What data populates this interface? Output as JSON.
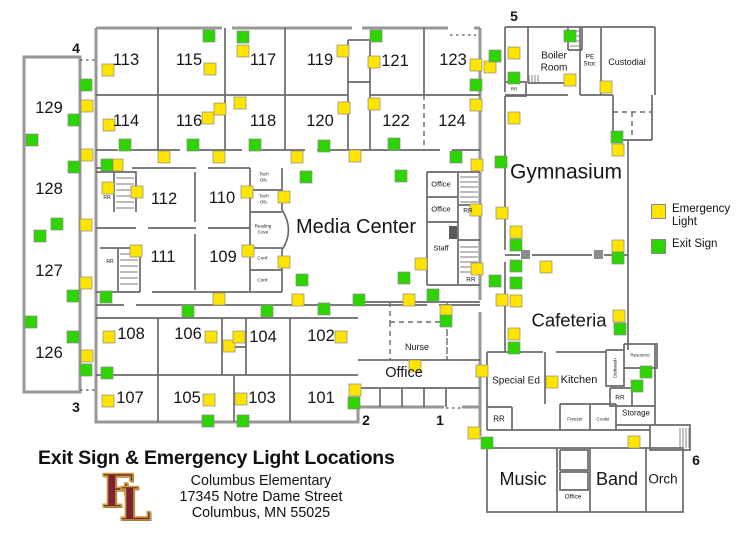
{
  "colors": {
    "emergency": "#ffe400",
    "exit": "#2ed400",
    "square_border": "#8a8a8a",
    "marker": "#d22b2b",
    "wall": "#6a6a6a",
    "outer_wall": "#979797"
  },
  "legend": {
    "emergency_label": "Emergency Light",
    "exit_label": "Exit Sign"
  },
  "title_block": {
    "title": "Exit Sign & Emergency Light Locations",
    "org": "Columbus Elementary",
    "address1": "17345 Notre Dame Street",
    "address2": "Columbus, MN 55025",
    "logo_letter1": "F",
    "logo_letter2": "L"
  },
  "floorplan": {
    "markers": [
      {
        "t": "1",
        "x": 440,
        "y": 420
      },
      {
        "t": "2",
        "x": 366,
        "y": 420
      },
      {
        "t": "3",
        "x": 76,
        "y": 407
      },
      {
        "t": "4",
        "x": 76,
        "y": 48
      },
      {
        "t": "5",
        "x": 514,
        "y": 16
      },
      {
        "t": "6",
        "x": 696,
        "y": 460
      }
    ],
    "labels": [
      {
        "t": "113",
        "x": 126,
        "y": 60,
        "s": 16.5
      },
      {
        "t": "115",
        "x": 189,
        "y": 60,
        "s": 16.5
      },
      {
        "t": "117",
        "x": 263,
        "y": 60,
        "s": 16.5
      },
      {
        "t": "119",
        "x": 320,
        "y": 60,
        "s": 16.5
      },
      {
        "t": "121",
        "x": 395,
        "y": 61,
        "s": 16.5
      },
      {
        "t": "123",
        "x": 453,
        "y": 60,
        "s": 16.5
      },
      {
        "t": "114",
        "x": 126,
        "y": 121,
        "s": 16.5
      },
      {
        "t": "116",
        "x": 189,
        "y": 121,
        "s": 16.5
      },
      {
        "t": "118",
        "x": 263,
        "y": 121,
        "s": 16.5
      },
      {
        "t": "120",
        "x": 320,
        "y": 121,
        "s": 16.5
      },
      {
        "t": "122",
        "x": 396,
        "y": 121,
        "s": 16.5
      },
      {
        "t": "124",
        "x": 452,
        "y": 121,
        "s": 16.5
      },
      {
        "t": "112",
        "x": 164,
        "y": 199,
        "s": 16.5
      },
      {
        "t": "110",
        "x": 222,
        "y": 198,
        "s": 16.5
      },
      {
        "t": "111",
        "x": 163,
        "y": 257,
        "s": 16.5
      },
      {
        "t": "109",
        "x": 223,
        "y": 257,
        "s": 16.5
      },
      {
        "t": "108",
        "x": 131,
        "y": 334,
        "s": 16.5
      },
      {
        "t": "106",
        "x": 188,
        "y": 334,
        "s": 16.5
      },
      {
        "t": "104",
        "x": 263,
        "y": 337,
        "s": 16.5
      },
      {
        "t": "102",
        "x": 321,
        "y": 336,
        "s": 16.5
      },
      {
        "t": "107",
        "x": 130,
        "y": 398,
        "s": 16.5
      },
      {
        "t": "105",
        "x": 187,
        "y": 398,
        "s": 16.5
      },
      {
        "t": "103",
        "x": 262,
        "y": 398,
        "s": 16.5
      },
      {
        "t": "101",
        "x": 321,
        "y": 398,
        "s": 16.5
      },
      {
        "t": "129",
        "x": 49,
        "y": 108,
        "s": 16.5
      },
      {
        "t": "128",
        "x": 49,
        "y": 189,
        "s": 16.5
      },
      {
        "t": "127",
        "x": 49,
        "y": 271,
        "s": 16.5
      },
      {
        "t": "126",
        "x": 49,
        "y": 353,
        "s": 16.5
      },
      {
        "t": "Media Center",
        "x": 356,
        "y": 227,
        "s": 20
      },
      {
        "t": "Gymnasium",
        "x": 566,
        "y": 172,
        "s": 21
      },
      {
        "t": "Cafeteria",
        "x": 569,
        "y": 320,
        "s": 18.5
      },
      {
        "t": "Office",
        "x": 404,
        "y": 373,
        "s": 14.5
      },
      {
        "t": "Music",
        "x": 523,
        "y": 479,
        "s": 18
      },
      {
        "t": "Band",
        "x": 617,
        "y": 479,
        "s": 18
      },
      {
        "t": "Orch",
        "x": 663,
        "y": 479,
        "s": 13.5
      },
      {
        "t": "Boiler",
        "x": 554,
        "y": 56,
        "s": 10
      },
      {
        "t": "Room",
        "x": 554,
        "y": 68,
        "s": 10
      },
      {
        "t": "PE",
        "x": 590,
        "y": 57,
        "s": 6.5
      },
      {
        "t": "Stor.",
        "x": 590,
        "y": 64,
        "s": 6.5
      },
      {
        "t": "Custodial",
        "x": 627,
        "y": 62,
        "s": 9
      },
      {
        "t": "RR",
        "x": 514,
        "y": 89,
        "s": 4.5
      },
      {
        "t": "RR",
        "x": 107,
        "y": 198,
        "s": 5
      },
      {
        "t": "RR",
        "x": 110,
        "y": 262,
        "s": 5
      },
      {
        "t": "RR",
        "x": 468,
        "y": 211,
        "s": 6.5
      },
      {
        "t": "RR",
        "x": 471,
        "y": 280,
        "s": 6.5
      },
      {
        "t": "RR",
        "x": 499,
        "y": 419,
        "s": 8
      },
      {
        "t": "RR",
        "x": 620,
        "y": 398,
        "s": 6.5
      },
      {
        "t": "Office",
        "x": 441,
        "y": 184,
        "s": 7.5
      },
      {
        "t": "Office",
        "x": 441,
        "y": 209,
        "s": 7.5
      },
      {
        "t": "Staff",
        "x": 441,
        "y": 248,
        "s": 7.5
      },
      {
        "t": "Tech",
        "x": 264,
        "y": 174,
        "s": 4.5
      },
      {
        "t": "Ofc.",
        "x": 264,
        "y": 180,
        "s": 4.5
      },
      {
        "t": "Tech",
        "x": 264,
        "y": 196,
        "s": 4.5
      },
      {
        "t": "Ofc.",
        "x": 264,
        "y": 202,
        "s": 4.5
      },
      {
        "t": "Reading",
        "x": 263,
        "y": 226,
        "s": 4.5
      },
      {
        "t": "Cove",
        "x": 263,
        "y": 232,
        "s": 4.5
      },
      {
        "t": "Conf.",
        "x": 263,
        "y": 259,
        "s": 4.8
      },
      {
        "t": "Conf.",
        "x": 263,
        "y": 281,
        "s": 4.8
      },
      {
        "t": "Nurse",
        "x": 417,
        "y": 347,
        "s": 9
      },
      {
        "t": "Special Ed",
        "x": 516,
        "y": 381,
        "s": 10
      },
      {
        "t": "Kitchen",
        "x": 579,
        "y": 380,
        "s": 11
      },
      {
        "t": "Freezer",
        "x": 575,
        "y": 419,
        "s": 4.5
      },
      {
        "t": "Cooler",
        "x": 603,
        "y": 419,
        "s": 4.5
      },
      {
        "t": "Storage",
        "x": 636,
        "y": 413,
        "s": 8
      },
      {
        "t": "Resource",
        "x": 640,
        "y": 355,
        "s": 4.5
      },
      {
        "t": "Dishwash",
        "x": 615,
        "y": 368,
        "s": 4.5,
        "r": -90
      },
      {
        "t": "Office",
        "x": 573,
        "y": 497,
        "s": 6.5
      }
    ],
    "emergency_lights": [
      [
        87,
        106
      ],
      [
        87,
        155
      ],
      [
        86,
        225
      ],
      [
        86,
        283
      ],
      [
        87,
        356
      ],
      [
        108,
        70
      ],
      [
        109,
        125
      ],
      [
        108,
        188
      ],
      [
        137,
        192
      ],
      [
        117,
        165
      ],
      [
        136,
        251
      ],
      [
        243,
        51
      ],
      [
        210,
        69
      ],
      [
        343,
        51
      ],
      [
        374,
        62
      ],
      [
        208,
        118
      ],
      [
        220,
        109
      ],
      [
        240,
        103
      ],
      [
        344,
        108
      ],
      [
        374,
        104
      ],
      [
        476,
        65
      ],
      [
        490,
        67
      ],
      [
        476,
        105
      ],
      [
        164,
        157
      ],
      [
        219,
        157
      ],
      [
        297,
        157
      ],
      [
        355,
        156
      ],
      [
        477,
        165
      ],
      [
        247,
        192
      ],
      [
        284,
        197
      ],
      [
        248,
        251
      ],
      [
        284,
        262
      ],
      [
        421,
        264
      ],
      [
        476,
        210
      ],
      [
        477,
        269
      ],
      [
        298,
        300
      ],
      [
        409,
        300
      ],
      [
        446,
        311
      ],
      [
        219,
        299
      ],
      [
        109,
        337
      ],
      [
        211,
        337
      ],
      [
        229,
        346
      ],
      [
        239,
        337
      ],
      [
        341,
        337
      ],
      [
        415,
        366
      ],
      [
        241,
        399
      ],
      [
        209,
        400
      ],
      [
        355,
        390
      ],
      [
        108,
        401
      ],
      [
        474,
        433
      ],
      [
        482,
        371
      ],
      [
        634,
        442
      ],
      [
        514,
        53
      ],
      [
        570,
        80
      ],
      [
        606,
        87
      ],
      [
        618,
        150
      ],
      [
        514,
        118
      ],
      [
        502,
        213
      ],
      [
        516,
        232
      ],
      [
        546,
        267
      ],
      [
        618,
        246
      ],
      [
        502,
        300
      ],
      [
        516,
        301
      ],
      [
        514,
        334
      ],
      [
        552,
        382
      ],
      [
        619,
        316
      ]
    ],
    "exit_signs": [
      [
        32,
        140
      ],
      [
        86,
        85
      ],
      [
        74,
        120
      ],
      [
        74,
        167
      ],
      [
        57,
        224
      ],
      [
        40,
        236
      ],
      [
        73,
        296
      ],
      [
        31,
        322
      ],
      [
        73,
        337
      ],
      [
        86,
        370
      ],
      [
        107,
        373
      ],
      [
        106,
        297
      ],
      [
        107,
        165
      ],
      [
        125,
        145
      ],
      [
        193,
        145
      ],
      [
        255,
        145
      ],
      [
        324,
        146
      ],
      [
        394,
        144
      ],
      [
        456,
        157
      ],
      [
        501,
        162
      ],
      [
        306,
        177
      ],
      [
        401,
        176
      ],
      [
        209,
        36
      ],
      [
        243,
        37
      ],
      [
        376,
        36
      ],
      [
        476,
        85
      ],
      [
        495,
        56
      ],
      [
        302,
        280
      ],
      [
        404,
        278
      ],
      [
        359,
        300
      ],
      [
        433,
        295
      ],
      [
        267,
        311
      ],
      [
        324,
        309
      ],
      [
        188,
        311
      ],
      [
        446,
        321
      ],
      [
        208,
        421
      ],
      [
        243,
        421
      ],
      [
        354,
        403
      ],
      [
        487,
        443
      ],
      [
        514,
        78
      ],
      [
        570,
        36
      ],
      [
        617,
        137
      ],
      [
        516,
        245
      ],
      [
        516,
        266
      ],
      [
        516,
        283
      ],
      [
        618,
        258
      ],
      [
        620,
        329
      ],
      [
        514,
        348
      ],
      [
        495,
        281
      ],
      [
        646,
        372
      ],
      [
        637,
        386
      ]
    ]
  }
}
